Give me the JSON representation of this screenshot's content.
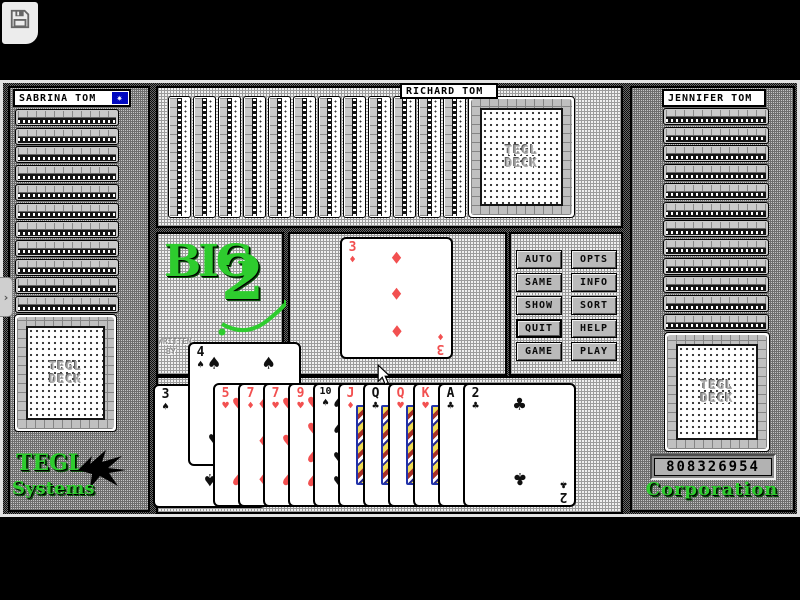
{
  "toolbar": {
    "save_icon": "floppy-disk"
  },
  "side_tab": {
    "glyph": "›"
  },
  "players": {
    "left": {
      "name": "SABRINA TOM",
      "card_count": 12,
      "turn_marker": true
    },
    "top": {
      "name": "RICHARD TOM",
      "card_count": 13
    },
    "right": {
      "name": "JENNIFER TOM",
      "card_count": 13,
      "score": "808326954"
    }
  },
  "logo": {
    "word": "BIG",
    "number": "2",
    "credit_line1": "WRITTEN",
    "credit_line2": "BY"
  },
  "deck": {
    "label_line1": "TEGL",
    "label_line2": "DECK"
  },
  "branding": {
    "bottom_left_line1": "TEGL",
    "bottom_left_line2": "Systems",
    "bottom_right": "Corporation"
  },
  "controls": {
    "buttons": [
      "AUTO",
      "OPTS",
      "SAME",
      "INFO",
      "SHOW",
      "SORT",
      "QUIT",
      "HELP",
      "GAME",
      "PLAY"
    ]
  },
  "table": {
    "played_card": {
      "rank": "3",
      "suit": "diamond"
    }
  },
  "hand": {
    "raised_card": {
      "rank": "4",
      "suit": "spade"
    },
    "cards": [
      {
        "rank": "3",
        "suit": "spade"
      },
      {
        "rank": "5",
        "suit": "heart"
      },
      {
        "rank": "7",
        "suit": "diamond"
      },
      {
        "rank": "7",
        "suit": "heart"
      },
      {
        "rank": "9",
        "suit": "heart"
      },
      {
        "rank": "10",
        "suit": "spade"
      },
      {
        "rank": "J",
        "suit": "diamond"
      },
      {
        "rank": "Q",
        "suit": "club"
      },
      {
        "rank": "Q",
        "suit": "heart"
      },
      {
        "rank": "K",
        "suit": "heart"
      },
      {
        "rank": "A",
        "suit": "club"
      },
      {
        "rank": "2",
        "suit": "club"
      }
    ]
  },
  "marker": {
    "glyph": "✷"
  },
  "colors": {
    "suit_red": "#f25050",
    "suit_black": "#101010",
    "logo_green": "#2ecc2e",
    "marker_blue": "#0008c0"
  }
}
